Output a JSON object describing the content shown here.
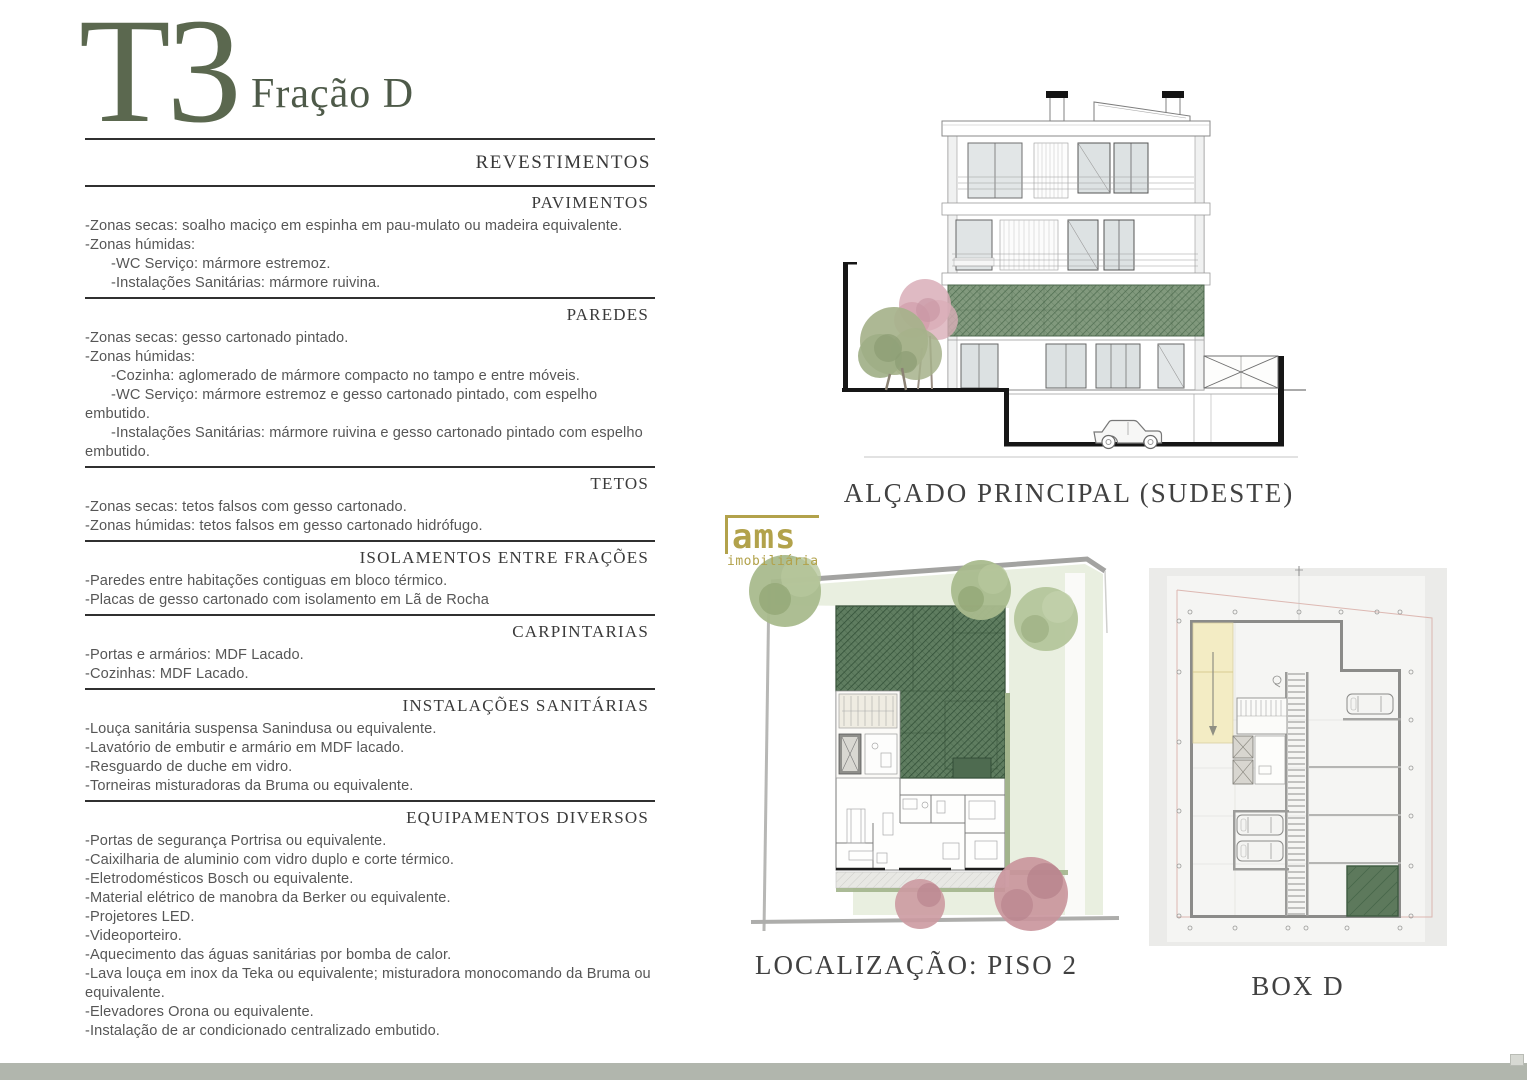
{
  "page": {
    "title": "T3",
    "subtitle": "Fração D"
  },
  "specs": {
    "heading": "REVESTIMENTOS",
    "sections": [
      {
        "title": "PAVIMENTOS",
        "items": [
          "-Zonas secas: soalho maciço em espinha em pau-mulato ou madeira equivalente.",
          "-Zonas húmidas:",
          "-WC Serviço: mármore estremoz.",
          "-Instalações Sanitárias: mármore ruivina."
        ]
      },
      {
        "title": "PAREDES",
        "items": [
          "-Zonas secas: gesso cartonado pintado.",
          "-Zonas húmidas:",
          "-Cozinha: aglomerado de mármore compacto no tampo e entre móveis.",
          "-WC Serviço: mármore estremoz  e gesso cartonado pintado, com espelho embutido.",
          "-Instalações Sanitárias: mármore ruivina e gesso cartonado pintado com espelho embutido."
        ]
      },
      {
        "title": "TETOS",
        "items": [
          "-Zonas secas: tetos falsos com gesso cartonado.",
          "-Zonas húmidas: tetos falsos em gesso cartonado hidrófugo."
        ]
      },
      {
        "title": "ISOLAMENTOS ENTRE FRAÇÕES",
        "items": [
          "-Paredes entre habitações contiguas em bloco térmico.",
          "-Placas de gesso cartonado com isolamento em Lã de Rocha"
        ]
      },
      {
        "title": "CARPINTARIAS",
        "items": [
          "-Portas e armários: MDF Lacado.",
          "-Cozinhas: MDF Lacado."
        ]
      },
      {
        "title": "INSTALAÇÕES SANITÁRIAS",
        "items": [
          "-Louça sanitária suspensa Sanindusa ou equivalente.",
          "-Lavatório de embutir e armário em MDF lacado.",
          "-Resguardo de duche em vidro.",
          "-Torneiras misturadoras da Bruma ou equivalente."
        ]
      },
      {
        "title": "EQUIPAMENTOS DIVERSOS",
        "items": [
          "-Portas de segurança Portrisa ou equivalente.",
          "-Caixilharia de aluminio com vidro duplo e corte térmico.",
          "-Eletrodomésticos Bosch ou equivalente.",
          "-Material elétrico de manobra da Berker ou equivalente.",
          "-Projetores LED.",
          "-Videoporteiro.",
          "-Aquecimento das águas sanitárias por bomba de calor.",
          "-Lava louça em inox da Teka ou equivalente; misturadora monocomando da Bruma ou equivalente.",
          "-Elevadores Orona ou equivalente.",
          "-Instalação de ar condicionado centralizado embutido."
        ]
      }
    ]
  },
  "figures": {
    "elevation": {
      "caption": "ALÇADO PRINCIPAL (SUDESTE)"
    },
    "siteplan": {
      "caption": "LOCALIZAÇÃO: PISO 2"
    },
    "boxd": {
      "caption": "BOX D"
    }
  },
  "watermark": {
    "line1": "ams",
    "line2": "imobiliária"
  },
  "colors": {
    "accent_green": "#5b684f",
    "hatch_green": "#5f7d60",
    "lawn_green": "#e9efe0",
    "ramp_yellow": "#f3ecc4",
    "watermark_gold": "#b2a24b",
    "scrollbar_gray": "#b1b6ad"
  }
}
